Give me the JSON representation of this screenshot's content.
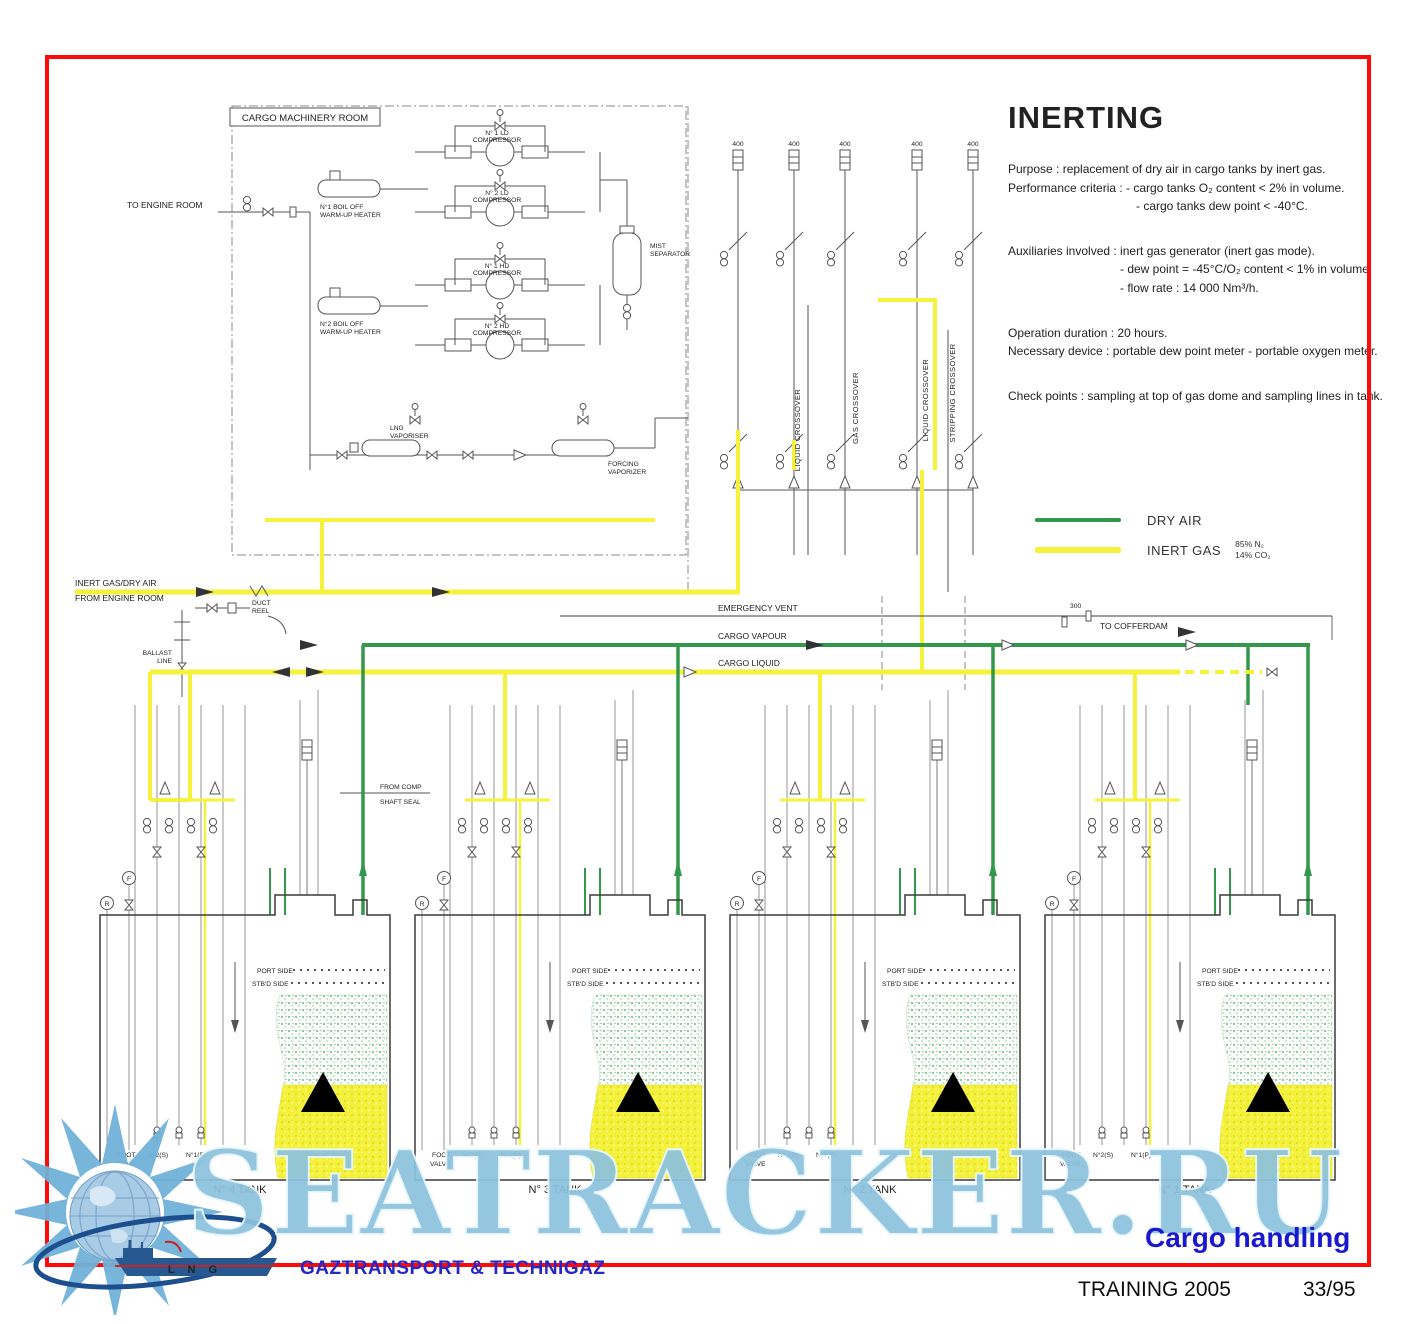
{
  "page": {
    "watermark": "SEATRACKER.RU"
  },
  "info": {
    "title": "INERTING",
    "p1": "Purpose : replacement of dry air in cargo tanks by inert gas.",
    "p2": "Performance criteria : - cargo tanks O₂ content < 2% in volume.",
    "p3": "- cargo tanks dew point < -40°C.",
    "p4": "Auxiliaries involved : inert gas generator (inert gas mode).",
    "p5": "- dew point = -45°C/O₂ content < 1% in volume.",
    "p6": "- flow rate : 14 000 Nm³/h.",
    "p7": "Operation duration : 20 hours.",
    "p8": "Necessary device : portable dew point meter - portable oxygen meter.",
    "p9": "Check points : sampling at top of gas dome and sampling lines in tank."
  },
  "legend": {
    "dry_air": "DRY AIR",
    "inert_gas": "INERT GAS",
    "n2": "85% N₂",
    "co2": "14% CO₂",
    "dry_air_color": "#33984b",
    "inert_gas_color": "#f5f23c"
  },
  "machinery": {
    "room": "CARGO MACHINERY ROOM",
    "to_engine_room": "TO ENGINE ROOM",
    "heater1a": "N°1 BOIL OFF",
    "heater1b": "WARM-UP HEATER",
    "heater2a": "N°2 BOIL OFF",
    "heater2b": "WARM-UP HEATER",
    "comp1a": "N° 1 LD",
    "comp2a": "N° 2 LD",
    "comp3a": "N° 1 HD",
    "comp4a": "N° 2 HD",
    "compb": "COMPRESSOR",
    "mista": "MIST",
    "mistb": "SEPARATOR",
    "lngva": "LNG",
    "lngvb": "VAPORISER",
    "forca": "FORCING",
    "forcb": "VAPORIZER"
  },
  "lines": {
    "inert1": "INERT GAS/DRY AIR",
    "inert2": "FROM ENGINE ROOM",
    "duct1": "DUCT",
    "duct2": "REEL",
    "ballast1": "BALLAST",
    "ballast2": "LINE",
    "emergency_vent": "EMERGENCY VENT",
    "cargo_vapour": "CARGO VAPOUR",
    "cargo_liquid": "CARGO LIQUID",
    "to_cofferdam": "TO COFFERDAM",
    "from_comp1": "FROM COMP",
    "from_comp2": "SHAFT SEAL",
    "liquid_crossover": "LIQUID CROSSOVER",
    "gas_crossover": "GAS CROSSOVER",
    "stripping_crossover": "STRIPPING CROSSOVER"
  },
  "tanks": {
    "common": {
      "port": "PORT SIDE",
      "stbd": "STB'D SIDE",
      "foot1": "FOOT",
      "foot2": "VALVE",
      "vs": "N°2(S)",
      "vp": "N°1(P)",
      "r": "R",
      "f": "F"
    },
    "t4": "N° 4 TANK",
    "t3": "N° 3 TANK",
    "t2": "N° 2 TANK",
    "t1": "N° 1 TANK"
  },
  "sizes": {
    "s400": "400",
    "s300": "300"
  },
  "footer": {
    "company": "GAZTRANSPORT & TECHNIGAZ",
    "subject": "Cargo handling",
    "training": "TRAINING 2005",
    "page": "33/95",
    "lng": "L N G"
  }
}
